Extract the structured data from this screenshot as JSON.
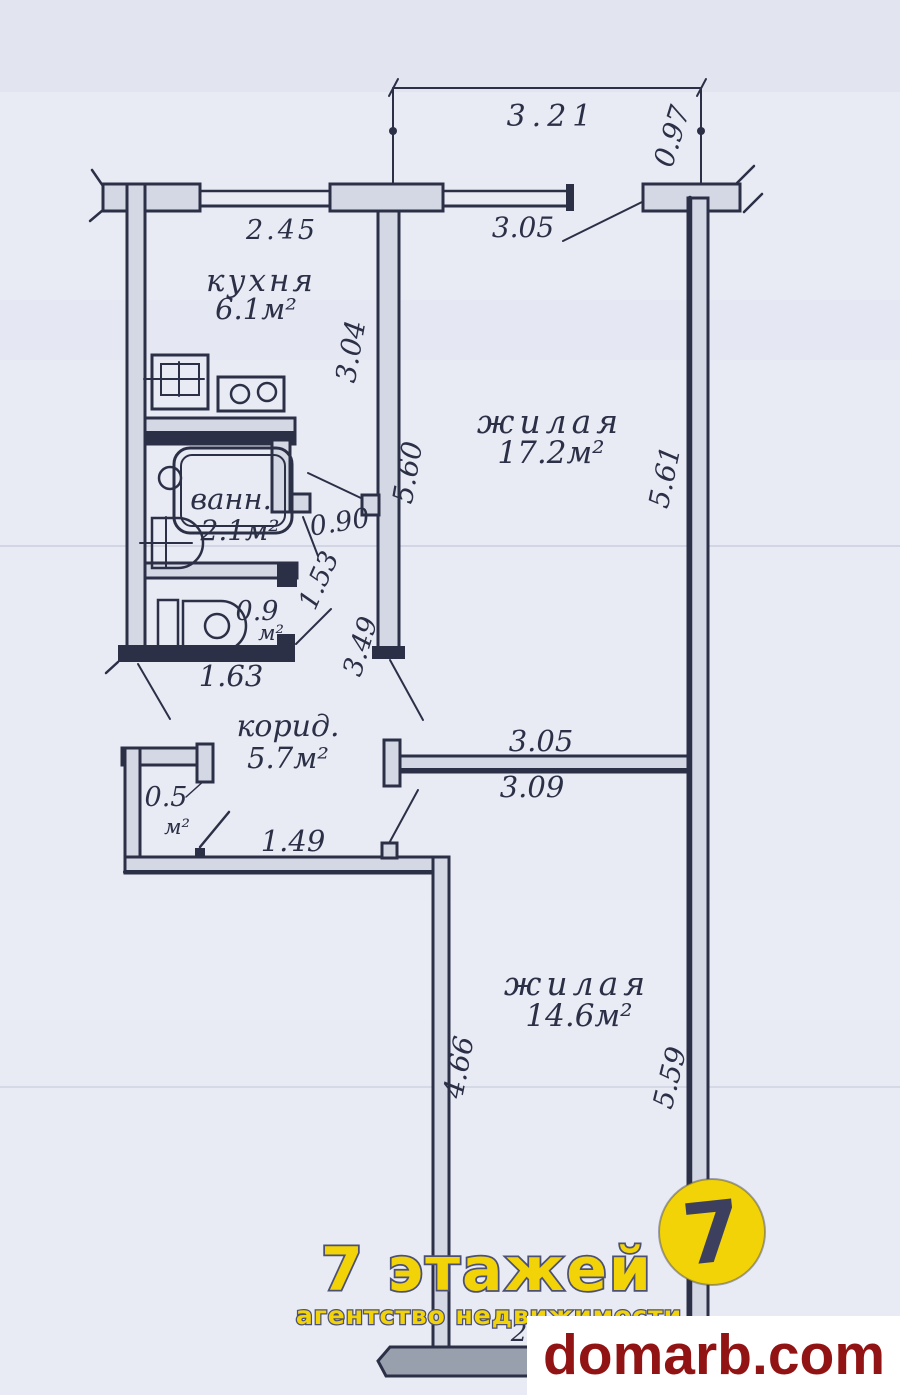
{
  "plan": {
    "rooms": {
      "kitchen": {
        "name": "кухня",
        "area": "6.1м²"
      },
      "living_main": {
        "name": "жилая",
        "area": "17.2м²"
      },
      "bathroom": {
        "name": "ванн.",
        "area": "2.1м²"
      },
      "toilet": {
        "area": "0.9",
        "unit": "м²"
      },
      "corridor": {
        "name": "корид.",
        "area": "5.7м²"
      },
      "closet": {
        "area": "0.5",
        "unit": "м²"
      },
      "living_second": {
        "name": "жилая",
        "area": "14.6м²"
      }
    },
    "dimensions": {
      "overall_top": "3.21",
      "top_offset": "0.97",
      "kitchen_width": "2.45",
      "window_span": "3.05",
      "kitchen_depth": "3.04",
      "living_main_depth_left": "5.60",
      "living_main_depth_right": "5.61",
      "bath_door_width": "0.90",
      "hall_segment": "1.53",
      "hall_depth": "3.49",
      "toilet_width": "1.63",
      "living_second_width_top": "3.05",
      "living_second_width": "3.09",
      "corridor_opening": "1.49",
      "living_second_depth_left": "4.66",
      "living_second_depth_right": "5.59",
      "partial_digit": "2"
    }
  },
  "branding": {
    "agency_name": "7 этажей",
    "agency_tagline": "агентство недвижимости",
    "logo_digit": "7",
    "website": "domarb.com"
  },
  "colors": {
    "ink": "#2c3047",
    "paper": "#e8eaf4",
    "wall_fill": "#d4d8e5",
    "pencil_fill": "#98a0ae",
    "accent_yellow": "#f2d307",
    "brand_red": "#921313"
  }
}
